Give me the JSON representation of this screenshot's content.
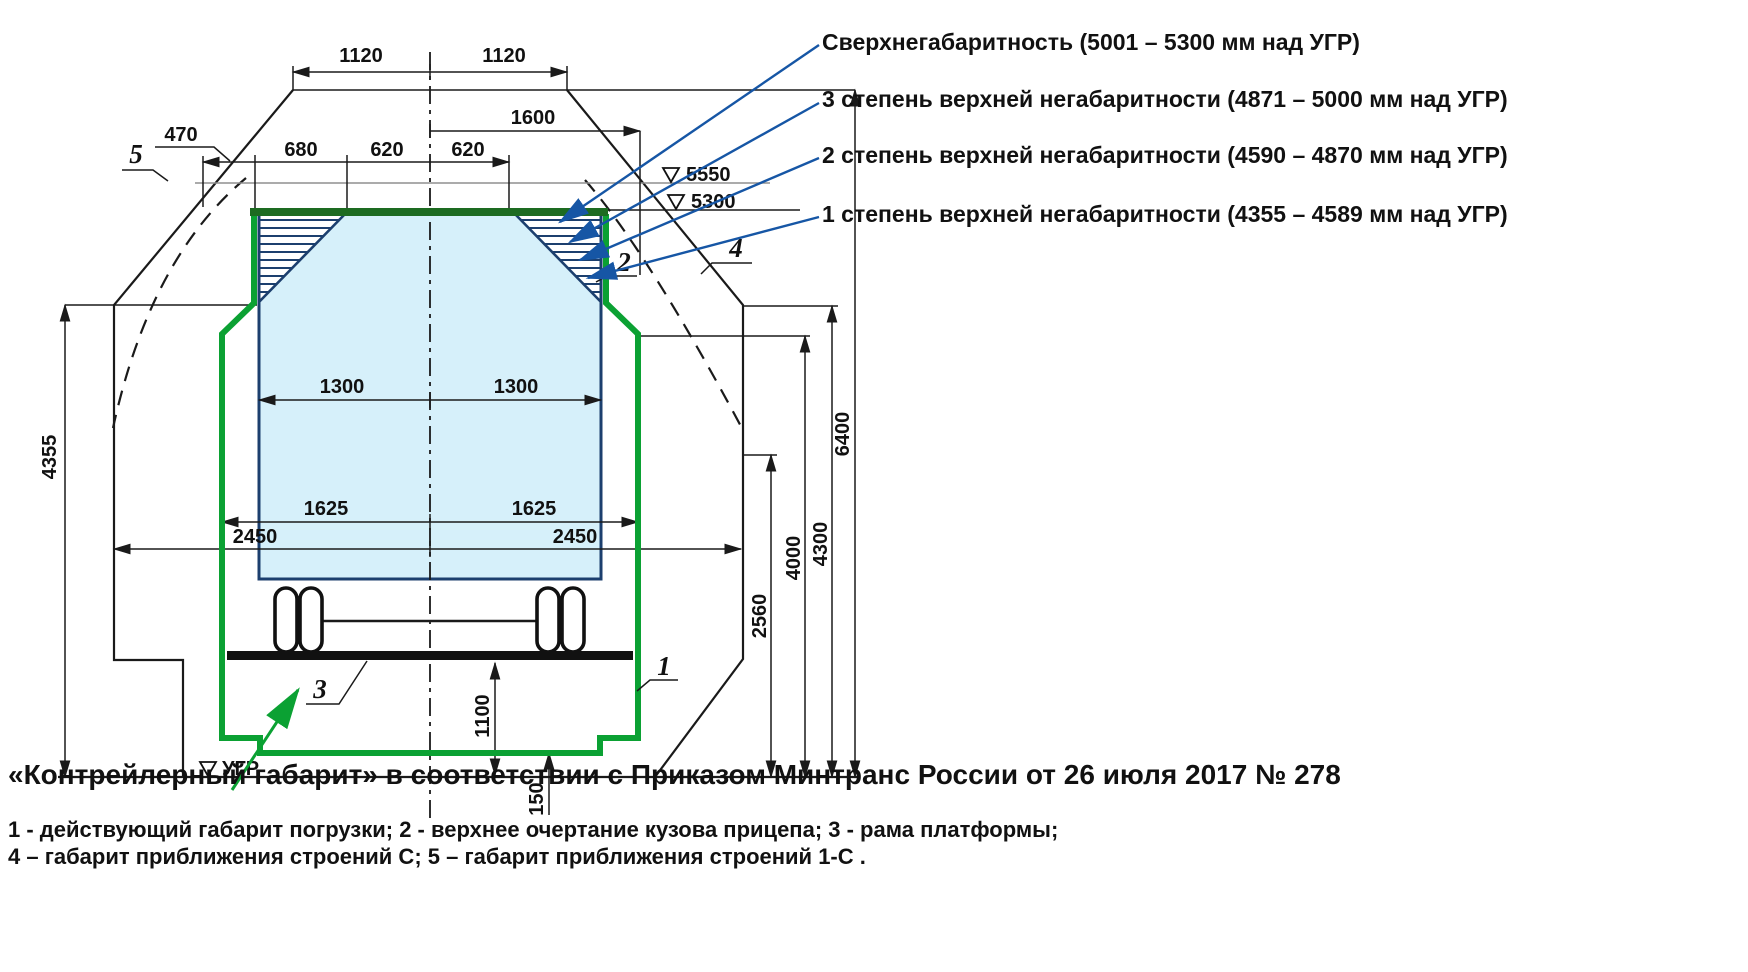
{
  "title": "Контрейлерный габарит — схема железнодорожного габарита",
  "legend": {
    "rows": [
      {
        "text": "Сверхнегабаритность (5001 – 5300 мм над УГР)"
      },
      {
        "text": "3 степень верхней негабаритности (4871 – 5000 мм над УГР)"
      },
      {
        "text": "2 степень верхней негабаритности (4590 – 4870 мм над УГР)"
      },
      {
        "text": "1 степень верхней негабаритности (4355 – 4589 мм над УГР)"
      }
    ]
  },
  "caption": "«Контрейлерный габарит»  в соответствии с Приказом  Минтранс  России от 26 июля 2017 № 278",
  "footnotes": {
    "line1": "1 - действующий габарит погрузки;  2 - верхнее очертание кузова прицепа;  3 -  рама платформы;",
    "line2": "4 –  габарит приближения строений С;  5  –  габарит приближения строений 1-С ."
  },
  "dims": {
    "top_half_left": "1120",
    "top_half_right": "1120",
    "upper_right_1600": "1600",
    "offset_470": "470",
    "w680": "680",
    "w620_left": "620",
    "w620_right": "620",
    "level_5550": "5550",
    "level_5300": "5300",
    "body_1300_left": "1300",
    "body_1300_right": "1300",
    "gauge_1625_left": "1625",
    "gauge_1625_right": "1625",
    "c_2450_left": "2450",
    "c_2450_right": "2450",
    "h4355": "4355",
    "h6400": "6400",
    "h4300": "4300",
    "h4000": "4000",
    "h2560": "2560",
    "h1100": "1100",
    "h150": "150",
    "rail_head_level": "УГР"
  },
  "callouts": {
    "n1": "1",
    "n2": "2",
    "n3": "3",
    "n4": "4",
    "n5": "5"
  },
  "colors": {
    "loading_gauge_green": "#0ba133",
    "loading_gauge_green_dark": "#1d6b21",
    "trailer_body_fill": "#d6f0fa",
    "trailer_body_outline": "#1c3f6e",
    "leader_blue": "#1656a5",
    "level_line_gray": "#8f8f8f"
  }
}
